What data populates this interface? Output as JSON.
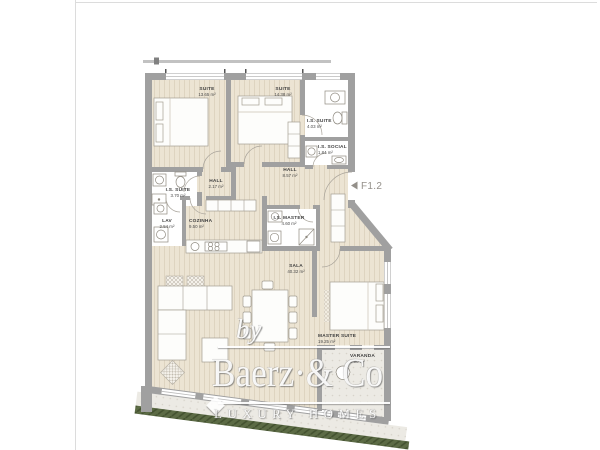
{
  "plan": {
    "marker": {
      "arrow_icon": "left-triangle",
      "label": "F1.2"
    },
    "rooms": [
      {
        "id": "suite-1",
        "name": "SUITE",
        "area": "13.65 m²"
      },
      {
        "id": "suite-2",
        "name": "SUITE",
        "area": "14.38 m²"
      },
      {
        "id": "is-suite-2",
        "name": "I.S. SUITE",
        "area": "4.03 m²"
      },
      {
        "id": "is-social",
        "name": "I.S. SOCIAL",
        "area": "1.84 m²"
      },
      {
        "id": "hall-main",
        "name": "HALL",
        "area": "8.57 m²"
      },
      {
        "id": "is-suite-1",
        "name": "I.S. SUITE",
        "area": "3.70 m²"
      },
      {
        "id": "hall-small",
        "name": "HALL",
        "area": "2.17 m²"
      },
      {
        "id": "lav",
        "name": "LAV",
        "area": "2.54 m²"
      },
      {
        "id": "cozinha",
        "name": "COZINHA",
        "area": "9.50 m²"
      },
      {
        "id": "is-master",
        "name": "I.S. MASTER",
        "area": "4.60 m²"
      },
      {
        "id": "sala",
        "name": "SALA",
        "area": "40.32 m²"
      },
      {
        "id": "master-suite",
        "name": "MASTER SUITE",
        "area": "19.25 m²"
      },
      {
        "id": "varanda",
        "name": "VARANDA",
        "area": "8.90 m²"
      }
    ],
    "colors": {
      "wall": "#a0a0a0",
      "wood_floor": "#ece4d3",
      "bath_floor": "#ffffff",
      "terrace_floor": "#eceae4",
      "hedge_green": "#5c6b45",
      "label_text": "#3f3f3f",
      "marker_text": "#94908a"
    }
  },
  "watermark": {
    "by": "by",
    "brand": "Baerz·& Co",
    "tagline": "LUXURY HOMES"
  }
}
